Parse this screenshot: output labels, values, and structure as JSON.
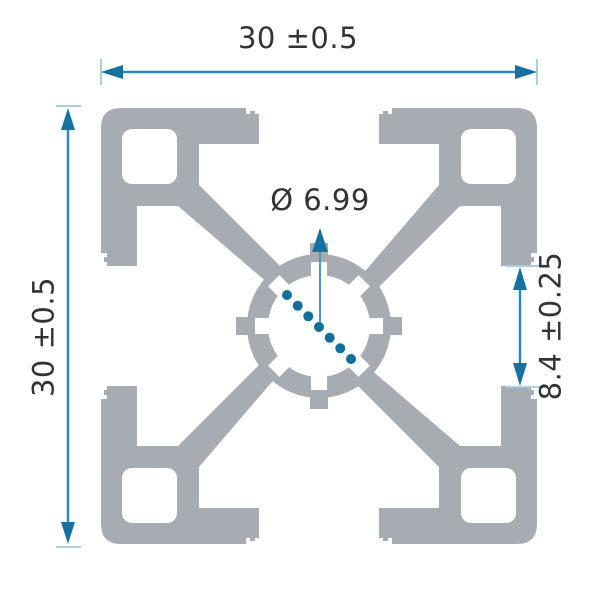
{
  "drawing": {
    "type": "technical cross-section drawing",
    "dimensions": {
      "width": {
        "value": "30",
        "tolerance": "±0.5",
        "label": "30 ±0.5"
      },
      "height": {
        "value": "30",
        "tolerance": "±0.5",
        "label": "30 ±0.5"
      },
      "center_bore": {
        "symbol": "Ø",
        "value": "6.99",
        "label": "Ø 6.99"
      },
      "slot_opening": {
        "value": "8.4",
        "tolerance": "±0.25",
        "label": "8.4 ±0.25"
      }
    },
    "colors": {
      "profile_fill": "#a7abb2",
      "dimension_accent": "#15719f",
      "dimension_line": "#2e89ae",
      "extension_tick": "#a9cede",
      "leader_line": "#4f9cba",
      "dot": "#0e6f9d",
      "text": "#333333",
      "background": "#ffffff"
    }
  }
}
